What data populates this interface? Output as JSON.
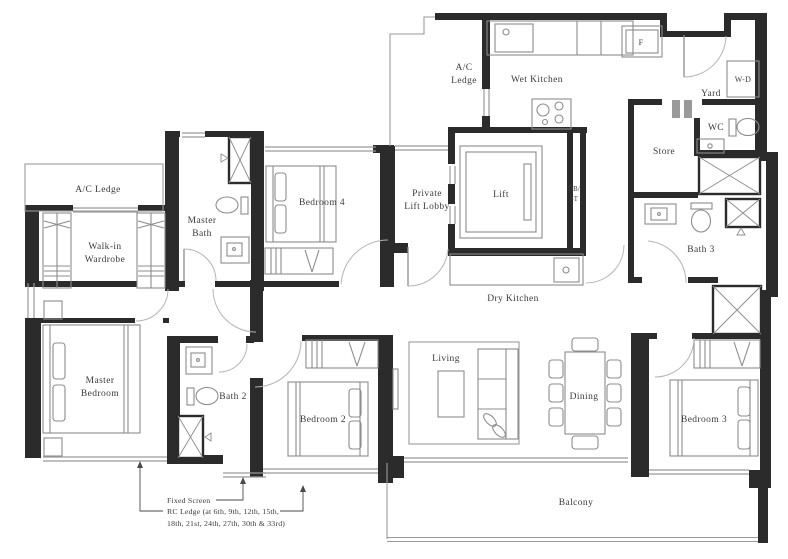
{
  "plan": {
    "type": "residential-unit-floor-plan",
    "rooms": {
      "ac_ledge_top": {
        "l1": "A/C",
        "l2": "Ledge"
      },
      "wet_kitchen": "Wet Kitchen",
      "yard": "Yard",
      "wc": "WC",
      "store": "Store",
      "bath3": "Bath 3",
      "lift": "Lift",
      "private_lift_lobby": {
        "l1": "Private",
        "l2": "Lift Lobby"
      },
      "db_st": {
        "l1": "DB/",
        "l2": "ST"
      },
      "dry_kitchen": "Dry Kitchen",
      "bedroom4": "Bedroom 4",
      "master_bath": {
        "l1": "Master",
        "l2": "Bath"
      },
      "ac_ledge_left": "A/C Ledge",
      "walk_in_wardrobe": {
        "l1": "Walk-in",
        "l2": "Wardrobe"
      },
      "master_bedroom": {
        "l1": "Master",
        "l2": "Bedroom"
      },
      "bath2": "Bath 2",
      "bedroom2": "Bedroom 2",
      "living": "Living",
      "dining": "Dining",
      "bedroom3": "Bedroom 3",
      "balcony": "Balcony"
    },
    "fixtures": {
      "fridge": "F",
      "washer_dryer": "W-D"
    },
    "annotations": {
      "fixed_screen": "Fixed Screen",
      "rc_ledge_line1": "RC Ledge (at 6th, 9th, 12th, 15th,",
      "rc_ledge_line2": "18th, 21st, 24th, 27th, 30th & 33rd)"
    },
    "palette": {
      "wall": "#2b2b2b",
      "furniture_line": "#8c8c8c",
      "thin_line": "#9a9a9a",
      "text": "#3a3a3a",
      "background": "#ffffff"
    }
  }
}
